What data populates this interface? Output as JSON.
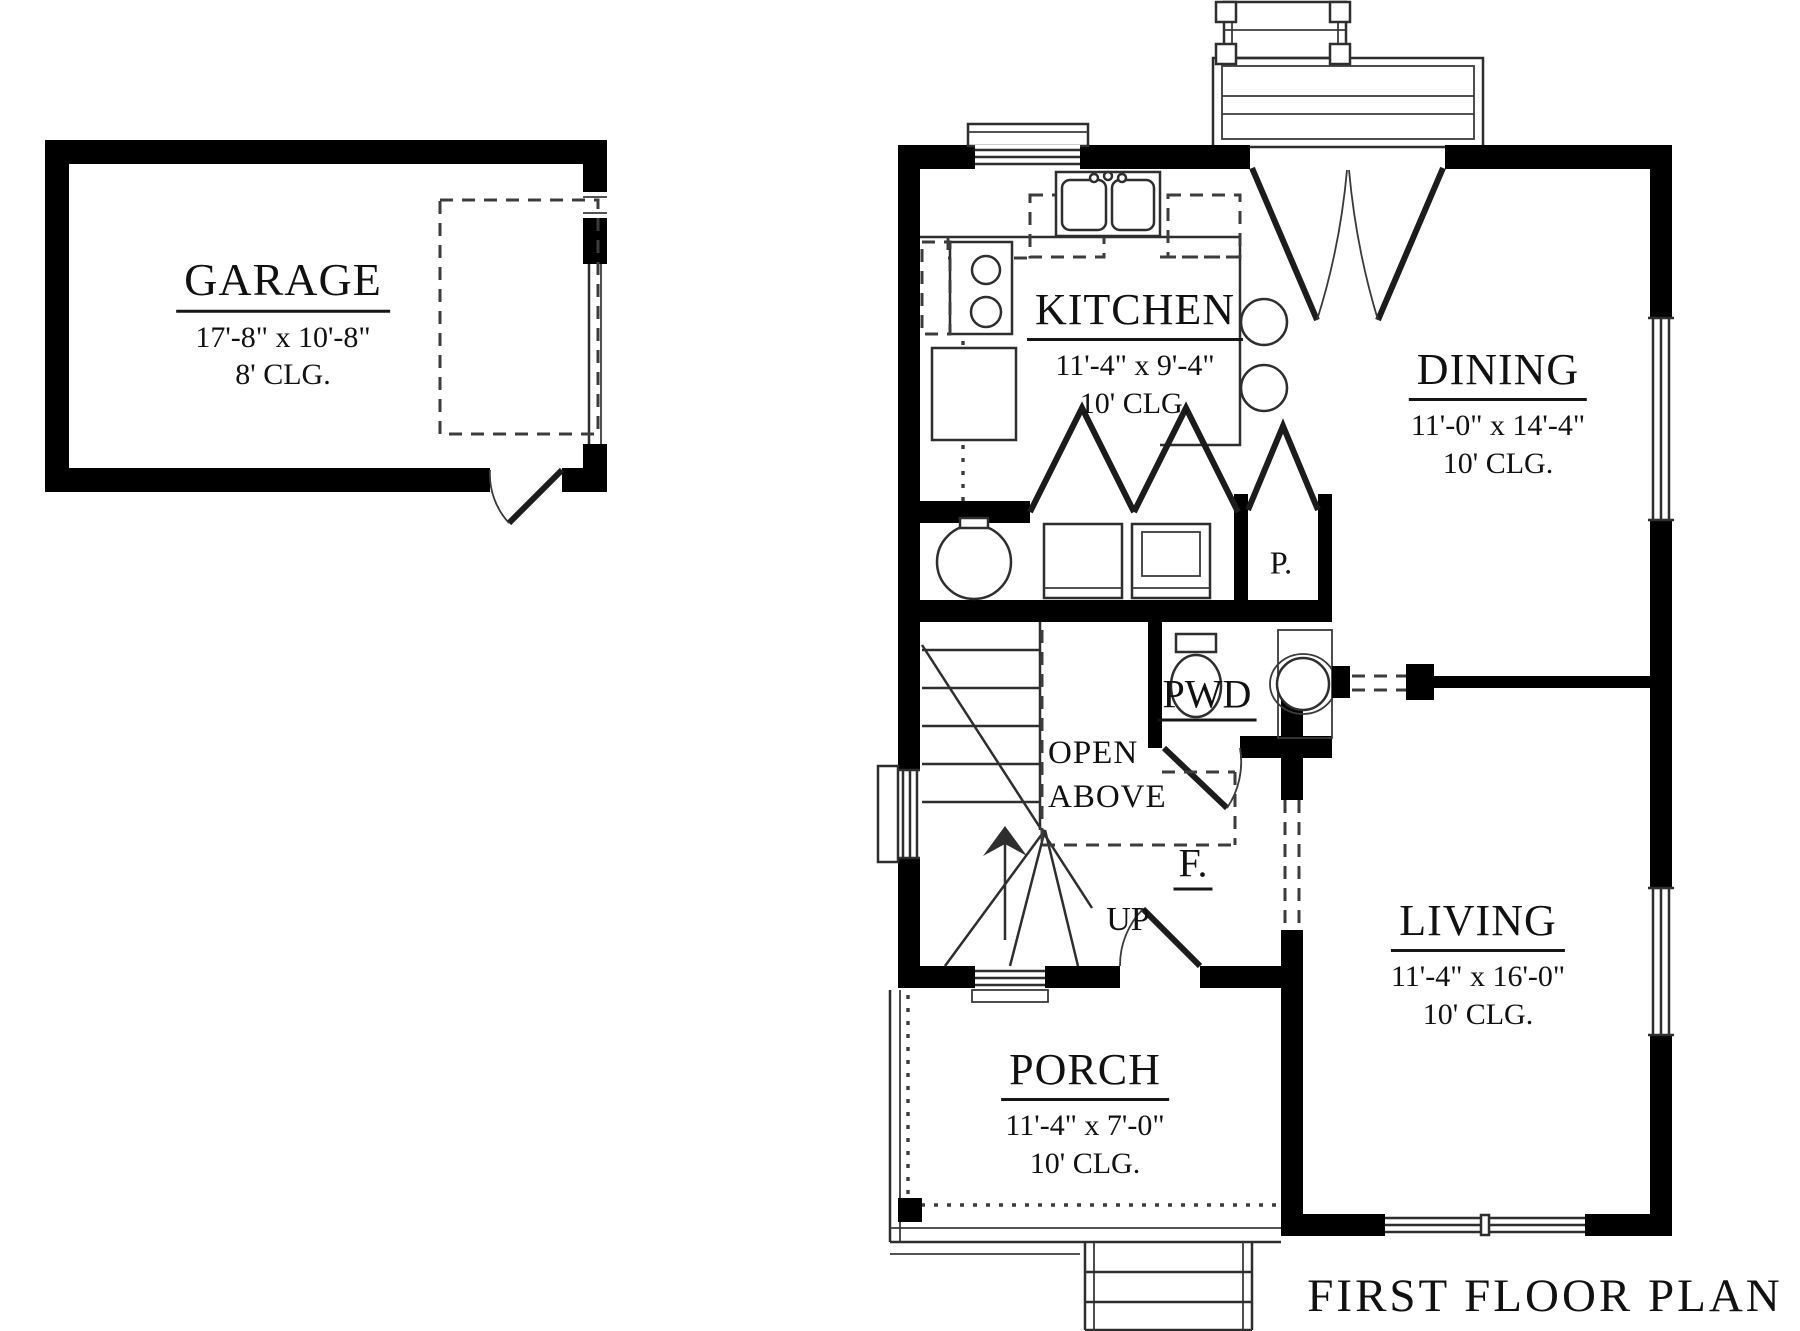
{
  "title": "FIRST FLOOR PLAN",
  "rooms": {
    "garage": {
      "name": "GARAGE",
      "dimensions": "17'-8\" x 10'-8\"",
      "ceiling": "8' CLG."
    },
    "kitchen": {
      "name": "KITCHEN",
      "dimensions": "11'-4\" x 9'-4\"",
      "ceiling": "10' CLG."
    },
    "dining": {
      "name": "DINING",
      "dimensions": "11'-0\" x 14'-4\"",
      "ceiling": "10' CLG."
    },
    "living": {
      "name": "LIVING",
      "dimensions": "11'-4\" x 16'-0\"",
      "ceiling": "10' CLG."
    },
    "porch": {
      "name": "PORCH",
      "dimensions": "11'-4\" x 7'-0\"",
      "ceiling": "10' CLG."
    },
    "powder": {
      "name": "PWD"
    },
    "pantry": {
      "name": "P."
    },
    "foyer": {
      "name": "F."
    }
  },
  "annotations": {
    "up": "UP",
    "open_above_line1": "OPEN",
    "open_above_line2": "ABOVE"
  },
  "colors": {
    "wall": "#000000",
    "line": "#2e2e2e",
    "background": "#ffffff"
  }
}
